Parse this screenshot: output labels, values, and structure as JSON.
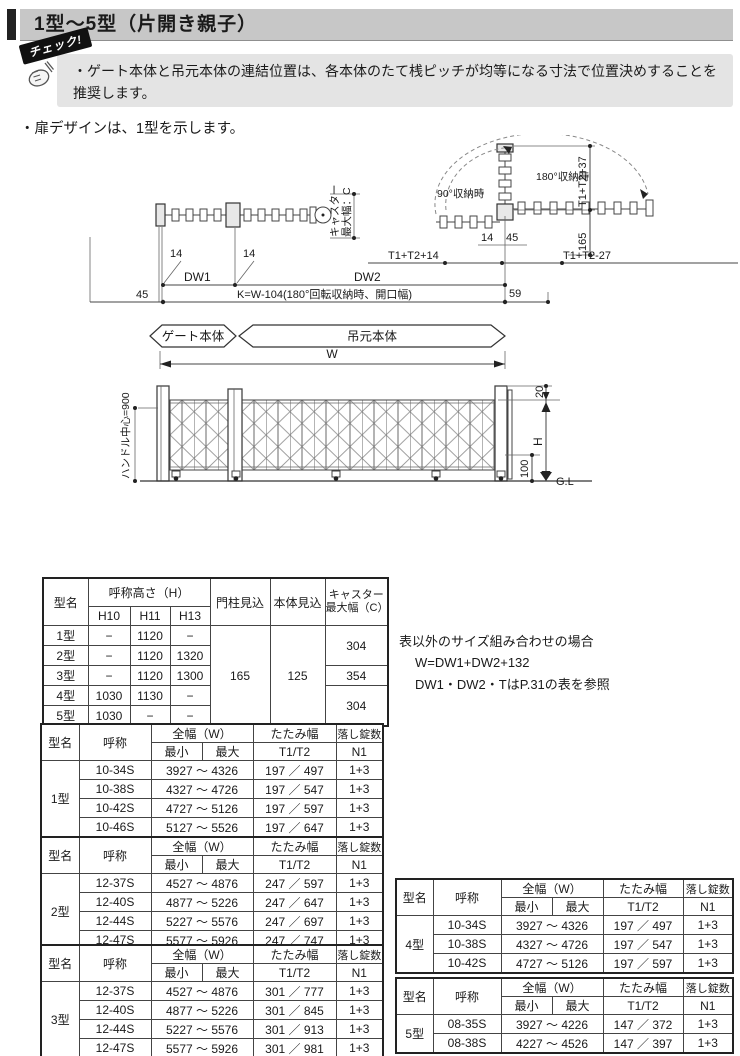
{
  "header": {
    "title": "1型～5型（片開き親子）"
  },
  "check": {
    "badge": "チェック!",
    "text": "・ゲート本体と吊元本体の連結位置は、各本体のたて桟ピッチが均等になる寸法で位置決めすることを推奨します。"
  },
  "notes": {
    "design": "・扉デザインは、1型を示します。"
  },
  "diagram": {
    "caster_line1": "キャスター",
    "caster_line2": "最大幅：C",
    "storage_90": "90°収納時",
    "storage_180": "180°収納時",
    "t1t2_37": "T1+T2+37",
    "d165": "165",
    "d14_right": "14",
    "d45_right": "45",
    "t1t2_14": "T1+T2+14",
    "t1t2_27": "T1+T2-27",
    "d14_left": "14",
    "d14_mid": "14",
    "dw1": "DW1",
    "dw2": "DW2",
    "d45_left": "45",
    "k_formula": "K=W-104(180°回転収納時、開口幅)",
    "d59": "59",
    "banner_gate": "ゲート本体",
    "banner_hinge": "吊元本体",
    "w": "W",
    "handle": "ハンドル中心=900",
    "d20": "20",
    "h": "H",
    "d100": "100",
    "gl": "G.L"
  },
  "size_note": {
    "line1": "表以外のサイズ組み合わせの場合",
    "line2": "W=DW1+DW2+132",
    "line3": "DW1・DW2・TはP.31の表を参照"
  },
  "spec_table": {
    "h_model": "型名",
    "h_height": "呼称高さ（H）",
    "h_h10": "H10",
    "h_h11": "H11",
    "h_h13": "H13",
    "h_post": "門柱見込",
    "h_body": "本体見込",
    "h_caster": "キャスター最大幅（C）",
    "post_value": "165",
    "body_value": "125",
    "rows": [
      {
        "model": "1型",
        "h10": "−",
        "h11": "1120",
        "h13": "−"
      },
      {
        "model": "2型",
        "h10": "−",
        "h11": "1120",
        "h13": "1320"
      },
      {
        "model": "3型",
        "h10": "−",
        "h11": "1120",
        "h13": "1300"
      },
      {
        "model": "4型",
        "h10": "1030",
        "h11": "1130",
        "h13": "−"
      },
      {
        "model": "5型",
        "h10": "1030",
        "h11": "−",
        "h13": "−"
      }
    ],
    "caster": [
      "304",
      "354",
      "304"
    ]
  },
  "size_headers": {
    "model": "型名",
    "name": "呼称",
    "width": "全幅（W）",
    "min": "最小",
    "max": "最大",
    "fold1": "たたみ幅",
    "fold2": "T1/T2",
    "lock1": "落し錠数",
    "lock2": "N1"
  },
  "size_tables": [
    {
      "model": "1型",
      "rows": [
        {
          "name": "10-34S",
          "range": "3927 ～ 4326",
          "fold": "197 ／ 497",
          "lock": "1+3"
        },
        {
          "name": "10-38S",
          "range": "4327 ～ 4726",
          "fold": "197 ／ 547",
          "lock": "1+3"
        },
        {
          "name": "10-42S",
          "range": "4727 ～ 5126",
          "fold": "197 ／ 597",
          "lock": "1+3"
        },
        {
          "name": "10-46S",
          "range": "5127 ～ 5526",
          "fold": "197 ／ 647",
          "lock": "1+3"
        }
      ]
    },
    {
      "model": "2型",
      "rows": [
        {
          "name": "12-37S",
          "range": "4527 ～ 4876",
          "fold": "247 ／ 597",
          "lock": "1+3"
        },
        {
          "name": "12-40S",
          "range": "4877 ～ 5226",
          "fold": "247 ／ 647",
          "lock": "1+3"
        },
        {
          "name": "12-44S",
          "range": "5227 ～ 5576",
          "fold": "247 ／ 697",
          "lock": "1+3"
        },
        {
          "name": "12-47S",
          "range": "5577 ～ 5926",
          "fold": "247 ／ 747",
          "lock": "1+3"
        }
      ]
    },
    {
      "model": "3型",
      "rows": [
        {
          "name": "12-37S",
          "range": "4527 ～ 4876",
          "fold": "301 ／ 777",
          "lock": "1+3"
        },
        {
          "name": "12-40S",
          "range": "4877 ～ 5226",
          "fold": "301 ／ 845",
          "lock": "1+3"
        },
        {
          "name": "12-44S",
          "range": "5227 ～ 5576",
          "fold": "301 ／ 913",
          "lock": "1+3"
        },
        {
          "name": "12-47S",
          "range": "5577 ～ 5926",
          "fold": "301 ／ 981",
          "lock": "1+3"
        }
      ]
    },
    {
      "model": "4型",
      "rows": [
        {
          "name": "10-34S",
          "range": "3927 ～ 4326",
          "fold": "197 ／ 497",
          "lock": "1+3"
        },
        {
          "name": "10-38S",
          "range": "4327 ～ 4726",
          "fold": "197 ／ 547",
          "lock": "1+3"
        },
        {
          "name": "10-42S",
          "range": "4727 ～ 5126",
          "fold": "197 ／ 597",
          "lock": "1+3"
        }
      ]
    },
    {
      "model": "5型",
      "rows": [
        {
          "name": "08-35S",
          "range": "3927 ～ 4226",
          "fold": "147 ／ 372",
          "lock": "1+3"
        },
        {
          "name": "08-38S",
          "range": "4227 ～ 4526",
          "fold": "147 ／ 397",
          "lock": "1+3"
        }
      ]
    }
  ]
}
